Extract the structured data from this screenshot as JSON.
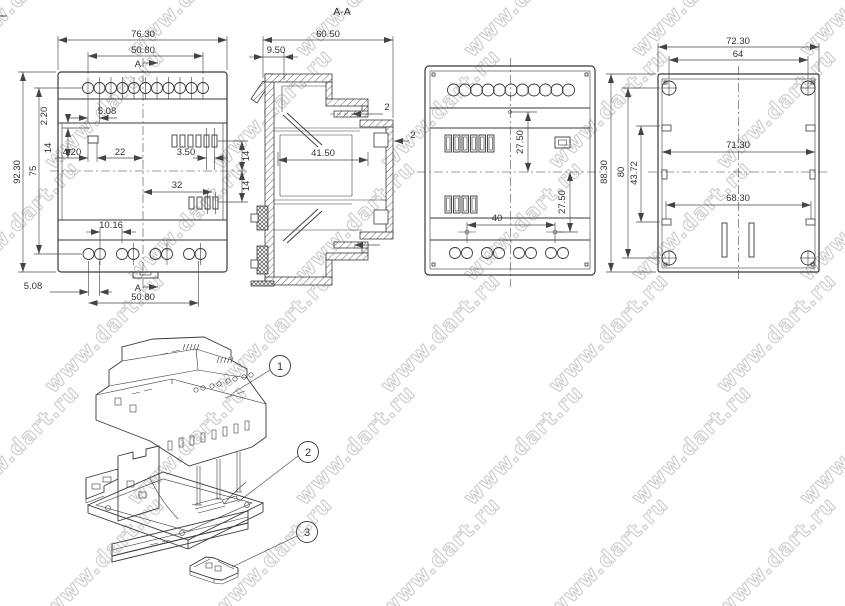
{
  "watermark": {
    "text": "www.dart.ru",
    "color": "#cccccc"
  },
  "drawing": {
    "line_color": "#3a3a3a",
    "dim_line_color": "#4a4a4a",
    "text_color": "#333333"
  },
  "views": {
    "front": {
      "section_label": "A",
      "dims": {
        "width_total": "76.30",
        "hole_span_top": "50.80",
        "hole_pitch_top": "5.08",
        "offset_small": "2.20",
        "left_span": "14",
        "slot_width": "4.20",
        "center_dist": "22",
        "slot_pitch": "3.50",
        "right_upper_span": "14",
        "right_lower_span": "14",
        "height_total": "92.30",
        "hole_rows_span": "75",
        "lower_center_dist": "32",
        "hole_pitch_bottom": "10.16",
        "pair_pitch_bottom": "5.08",
        "hole_span_bottom": "50.80"
      }
    },
    "section": {
      "title": "A-A",
      "dims": {
        "depth_total": "60.50",
        "front_step": "9.50",
        "rib_thickness": "2",
        "wall_thickness": "2",
        "cavity_width": "41.50"
      }
    },
    "back": {
      "dims": {
        "upper_offset": "27.50",
        "lower_offset": "27.50",
        "mount_hole_span": "40"
      }
    },
    "inside": {
      "dims": {
        "width_total": "72.30",
        "screw_span": "64",
        "inner_width": "71.30",
        "hook_span": "68.30",
        "height_total": "88.30",
        "screw_height": "80",
        "hook_height": "43.72"
      }
    }
  },
  "exploded": {
    "balloons": [
      {
        "label": "1"
      },
      {
        "label": "2"
      },
      {
        "label": "3"
      }
    ]
  }
}
